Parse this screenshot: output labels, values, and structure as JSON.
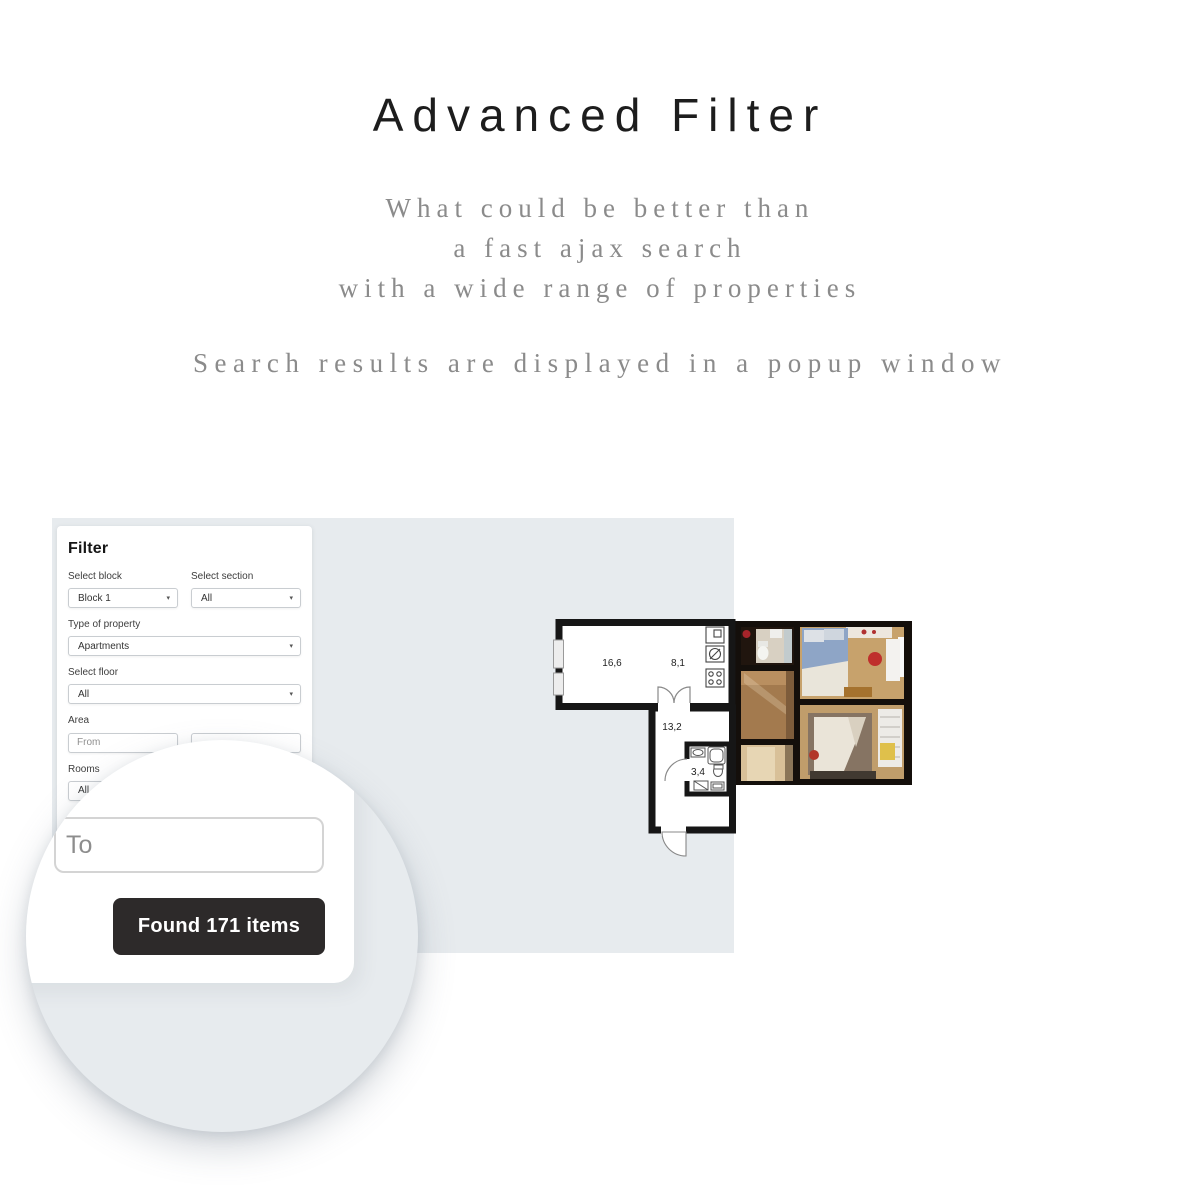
{
  "hero": {
    "title": "Advanced Filter",
    "subtitle_lines": [
      "What could be better than",
      "a fast ajax search",
      "with a wide range of properties"
    ],
    "tagline": "Search results are displayed in a popup window"
  },
  "filter": {
    "heading": "Filter",
    "block": {
      "label": "Select block",
      "value": "Block 1"
    },
    "section": {
      "label": "Select section",
      "value": "All"
    },
    "property_type": {
      "label": "Type of property",
      "value": "Apartments"
    },
    "floor": {
      "label": "Select floor",
      "value": "All"
    },
    "area": {
      "label": "Area",
      "from_placeholder": "From"
    },
    "rooms": {
      "label": "Rooms",
      "value": "All"
    }
  },
  "magnifier": {
    "area_to_placeholder": "To",
    "results_button_label": "Found 171 items"
  },
  "floor_plan": {
    "room_labels": {
      "living_room": "16,6",
      "kitchen": "8,1",
      "hallway": "13,2",
      "bathroom": "3,4"
    }
  },
  "icons": {
    "dropdown_caret": "▾"
  },
  "colors": {
    "panel_background": "#e7ebee",
    "results_button_background": "#2d2a2a",
    "heading_text": "#1d1d1d",
    "subtitle_text": "#8b8b8b"
  }
}
